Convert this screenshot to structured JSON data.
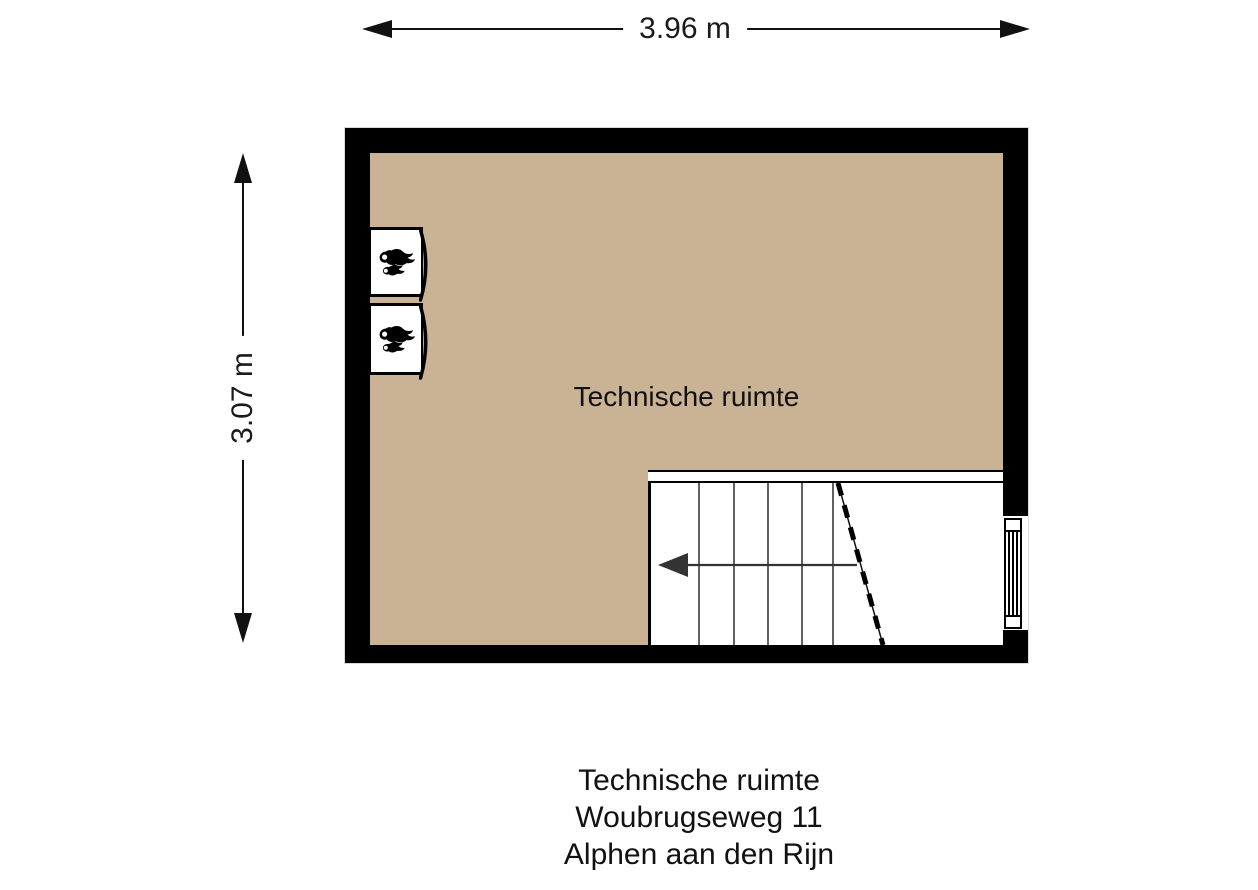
{
  "floorplan": {
    "room_label": "Technische ruimte",
    "dimension_width": {
      "label": "3.96 m"
    },
    "dimension_height": {
      "label": "3.07 m"
    },
    "colors": {
      "wall": "#000000",
      "floor": "#cab295",
      "stair_area": "#ffffff",
      "line": "#111111"
    },
    "fixtures": {
      "boiler_count": 2,
      "stair_tread_count": 6,
      "window_wall": "right"
    }
  },
  "caption": {
    "lines": [
      "Technische ruimte",
      "Woubrugseweg 11",
      "Alphen aan den Rijn"
    ]
  }
}
